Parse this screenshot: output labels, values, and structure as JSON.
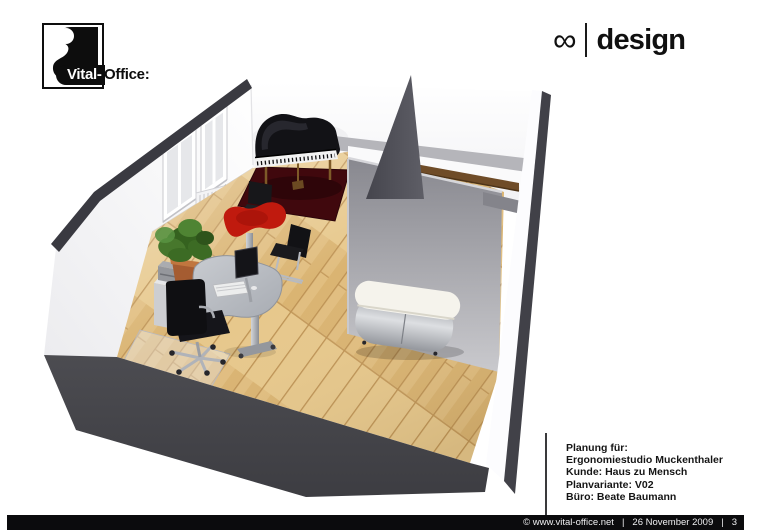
{
  "brand": {
    "logo_left": "Vital-",
    "logo_right": "Office:"
  },
  "design_logo": {
    "infinity": "∞",
    "divider": "|",
    "label": "design"
  },
  "plan_info": {
    "lines": [
      "Planung für:",
      "Ergonomiestudio Muckenthaler",
      "Kunde: Haus zu Mensch",
      "Planvariante: V02",
      "Büro: Beate Baumann"
    ]
  },
  "footer": {
    "copyright": "© www.vital-office.net",
    "separator": "|",
    "date": "26 November 2009",
    "page": "3"
  },
  "scene": {
    "type": "3d-room-rendering",
    "objects": [
      "grand-piano",
      "dark-red-rug",
      "piano-chair",
      "red-pedestal-table",
      "black-cantilever-chair",
      "kidney-shaped-desk",
      "desk-monitor",
      "keyboard",
      "black-swivel-chair",
      "chair-floor-mat",
      "printer-stand",
      "printer",
      "potted-plant",
      "radiator",
      "wall-rails",
      "casement-windows",
      "partition-wall",
      "triangular-wall-fin",
      "rounded-sideboard",
      "wooden-floor"
    ],
    "colors": {
      "floor_wood": "#e1be80",
      "wall_white": "#ffffff",
      "structure_dark": "#46464b",
      "partition_gray": "#a9a9ae",
      "rug_red": "#40080d",
      "table_red": "#c4190d",
      "wood_cap": "#6f4c28",
      "sideboard_top": "#f5f3ec",
      "chrome": "#b5b8bd"
    }
  }
}
